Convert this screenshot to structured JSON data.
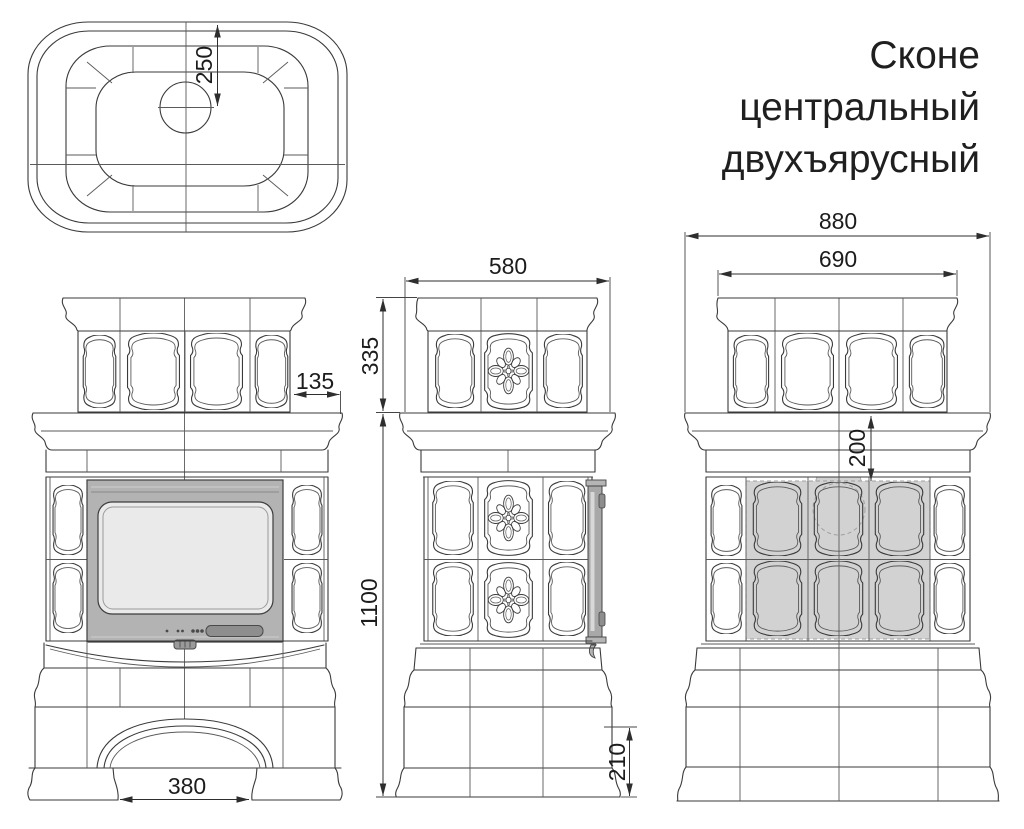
{
  "title": {
    "line1": "Сконе",
    "line2": "центральный",
    "line3": "двухъярусный"
  },
  "views": {
    "top": {
      "dim_chimney_offset": "250"
    },
    "front": {
      "dim_upper_tier_inset": "135",
      "dim_niche_width": "380"
    },
    "side": {
      "dim_depth": "580",
      "dim_upper_tier_height": "335",
      "dim_body_height": "1100",
      "dim_plinth_height": "210"
    },
    "back": {
      "dim_overall_width": "880",
      "dim_upper_tier_width": "690",
      "dim_cornice_to_heat_zone": "200"
    }
  },
  "colors": {
    "line": "#3a3a3a",
    "dimension_text": "#1c1c1c",
    "insert_frame": "#b3b3b3",
    "insert_glass": "#eaeaea",
    "handle": "#8e8e8e",
    "shaded_tiles": "#d2d2d2",
    "title_text": "#1f1f1f"
  }
}
